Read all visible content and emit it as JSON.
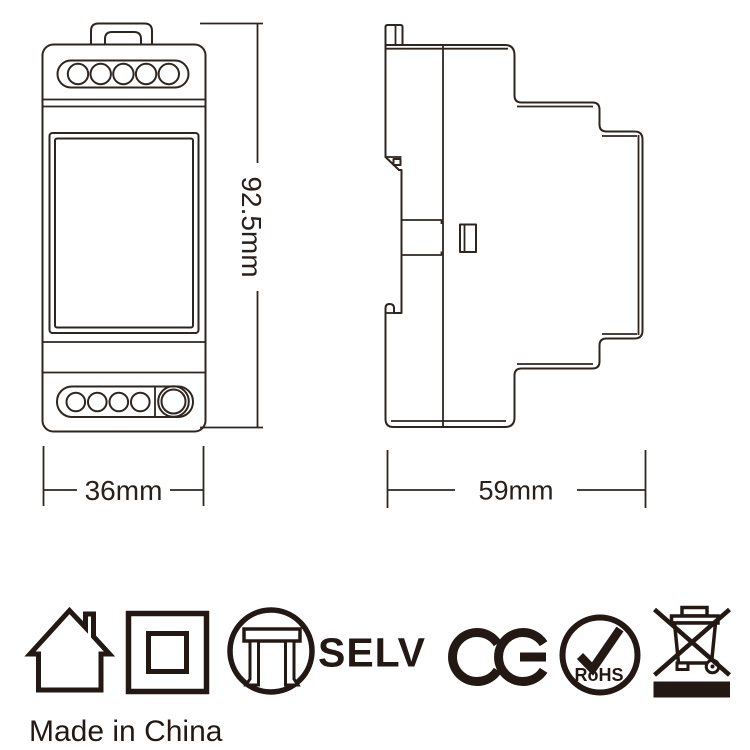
{
  "page": {
    "background_color": "#ffffff",
    "line_color": "#2e2520",
    "icon_color": "#231813"
  },
  "front_view": {
    "description": "front view of DIN-rail module with terminal holes, label window and button",
    "height_label": "92.5mm",
    "width_label": "36mm",
    "top_terminal_count": 5,
    "bottom_terminal_count": 4
  },
  "side_view": {
    "description": "side profile of DIN-rail module with mounting clip",
    "width_label": "59mm"
  },
  "certifications": {
    "selv_label": "SELV",
    "ce_label": "CE",
    "rohs_label": "RoHS",
    "icons": [
      {
        "name": "indoor-use-house-icon"
      },
      {
        "name": "class-ii-double-insulation-icon"
      },
      {
        "name": "independent-control-gear-icon"
      },
      {
        "name": "selv-label"
      },
      {
        "name": "ce-mark-icon"
      },
      {
        "name": "rohs-check-icon"
      },
      {
        "name": "weee-crossed-bin-icon"
      }
    ]
  },
  "footer": {
    "made_in_china": "Made in China"
  }
}
